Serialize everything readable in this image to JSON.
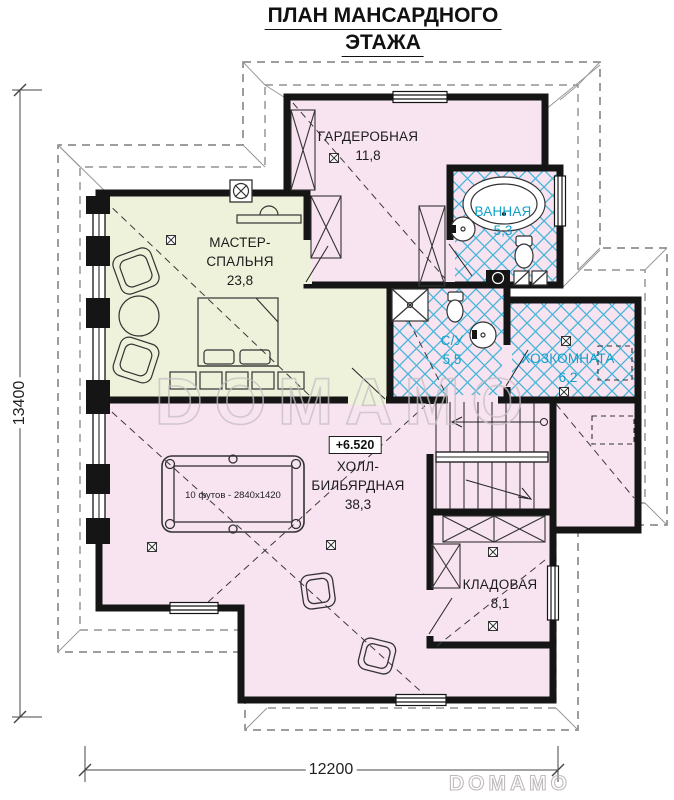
{
  "title": {
    "line1": "ПЛАН МАНСАРДНОГО",
    "line2": "ЭТАЖА"
  },
  "rooms": {
    "wardrobe": {
      "name": "ГАРДЕРОБНАЯ",
      "area": "11,8"
    },
    "bathroom": {
      "name": "ВАННАЯ",
      "area": "5,3"
    },
    "master": {
      "name_lines": [
        "МАСТЕР-",
        "СПАЛЬНЯ"
      ],
      "area": "23,8"
    },
    "wc": {
      "name": "С/У",
      "area": "5,5"
    },
    "utility": {
      "name": "ХОЗКОМНАТА",
      "area": "6,2"
    },
    "hall": {
      "name_lines": [
        "ХОЛЛ-",
        "БИЛЬЯРДНАЯ"
      ],
      "area": "38,3"
    },
    "storage": {
      "name": "КЛАДОВАЯ",
      "area": "8,1"
    }
  },
  "annotations": {
    "elevation_mark": "+6.520",
    "billiard_table_label": "10 футов - 2840x1420"
  },
  "dimensions": {
    "left_vertical": "13400",
    "bottom_horizontal": "12200"
  },
  "watermarks": {
    "center": "DOMAMO",
    "corner": "DOMAMO"
  },
  "colors": {
    "room_pink": "#f8e3f1",
    "room_green": "#eef2da",
    "tile_blue": "#45b6d8",
    "wet_label_blue": "#12a0ca",
    "wall_black": "#151515",
    "roof_line": "#7d7d7d"
  }
}
